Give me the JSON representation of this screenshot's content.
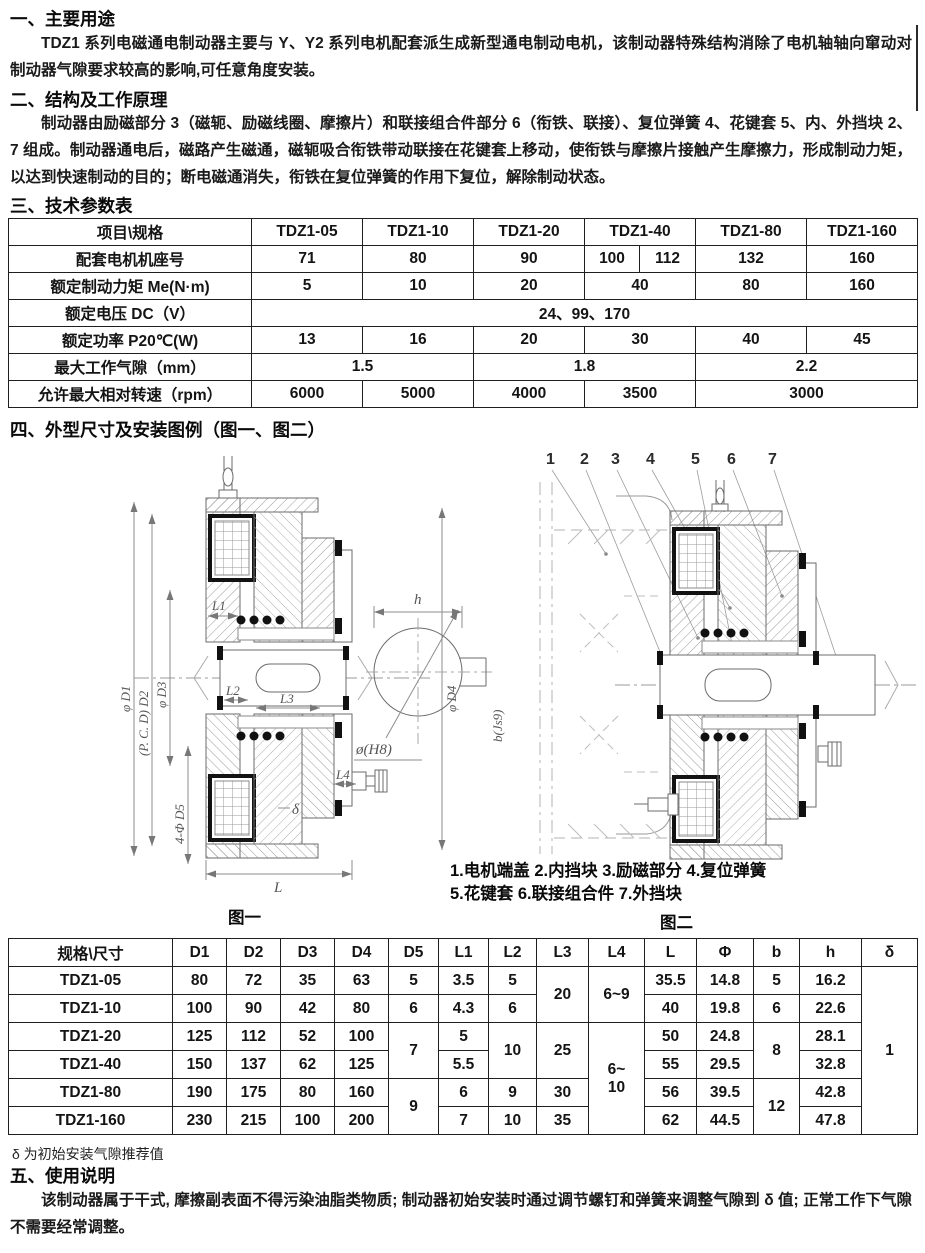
{
  "doc": {
    "s1_heading": "一、主要用途",
    "s1_body": "TDZ1 系列电磁通电制动器主要与 Y、Y2 系列电机配套派生成新型通电制动电机，该制动器特殊结构消除了电机轴轴向窜动对制动器气隙要求较高的影响,可任意角度安装。",
    "s2_heading": "二、结构及工作原理",
    "s2_body": "制动器由励磁部分 3（磁轭、励磁线圈、摩擦片）和联接组合件部分 6（衔铁、联接）、复位弹簧 4、花键套 5、内、外挡块 2、7 组成。制动器通电后，磁路产生磁通，磁轭吸合衔铁带动联接在花键套上移动，使衔铁与摩擦片接触产生摩擦力，形成制动力矩，以达到快速制动的目的；断电磁通消失，衔铁在复位弹簧的作用下复位，解除制动状态。",
    "s3_heading": "三、技术参数表",
    "s4_heading": "四、外型尺寸及安装图例（图一、图二）",
    "s5_heading": "五、使用说明",
    "s5_body": "该制动器属于干式, 摩擦副表面不得污染油脂类物质; 制动器初始安装时通过调节螺钉和弹簧来调整气隙到 δ 值; 正常工作下气隙不需要经常调整。",
    "dims_footnote": "δ 为初始安装气隙推荐值"
  },
  "params_table": {
    "header": [
      "项目\\规格",
      "TDZ1-05",
      "TDZ1-10",
      "TDZ1-20",
      "TDZ1-40",
      "TDZ1-80",
      "TDZ1-160"
    ],
    "frame_row": {
      "label": "配套电机机座号",
      "v": [
        "71",
        "80",
        "90",
        "100",
        "112",
        "132",
        "160"
      ]
    },
    "torque_row": {
      "label": "额定制动力矩 Me(N·m)",
      "v": [
        "5",
        "10",
        "20",
        "40",
        "80",
        "160"
      ]
    },
    "voltage_row": {
      "label": "额定电压 DC（V）",
      "v": "24、99、170"
    },
    "power_row": {
      "label": "额定功率 P20℃(W)",
      "v": [
        "13",
        "16",
        "20",
        "30",
        "40",
        "45"
      ]
    },
    "gap_row": {
      "label": "最大工作气隙（mm）",
      "v": [
        "1.5",
        "1.8",
        "2.2"
      ]
    },
    "speed_row": {
      "label": "允许最大相对转速（rpm）",
      "v": [
        "6000",
        "5000",
        "4000",
        "3500",
        "3000"
      ]
    }
  },
  "dims_table": {
    "header": [
      "规格\\尺寸",
      "D1",
      "D2",
      "D3",
      "D4",
      "D5",
      "L1",
      "L2",
      "L3",
      "L4",
      "L",
      "Φ",
      "b",
      "h",
      "δ"
    ],
    "r05": {
      "spec": "TDZ1-05",
      "D1": "80",
      "D2": "72",
      "D3": "35",
      "D4": "63",
      "D5": "5",
      "L1": "3.5",
      "L2": "5",
      "L3": "20",
      "L4": "6~9",
      "L": "35.5",
      "Phi": "14.8",
      "b": "5",
      "h": "16.2",
      "delta": "1"
    },
    "r10": {
      "spec": "TDZ1-10",
      "D1": "100",
      "D2": "90",
      "D3": "42",
      "D4": "80",
      "D5": "6",
      "L1": "4.3",
      "L2": "6",
      "L": "40",
      "Phi": "19.8",
      "b": "6",
      "h": "22.6"
    },
    "r20": {
      "spec": "TDZ1-20",
      "D1": "125",
      "D2": "112",
      "D3": "52",
      "D4": "100",
      "D5": "7",
      "L1": "5",
      "L2": "10",
      "L3": "25",
      "L4a": "6~",
      "L4b": "10",
      "L": "50",
      "Phi": "24.8",
      "b": "8",
      "h": "28.1"
    },
    "r40": {
      "spec": "TDZ1-40",
      "D1": "150",
      "D2": "137",
      "D3": "62",
      "D4": "125",
      "L1": "5.5",
      "L": "55",
      "Phi": "29.5",
      "h": "32.8"
    },
    "r80": {
      "spec": "TDZ1-80",
      "D1": "190",
      "D2": "175",
      "D3": "80",
      "D4": "160",
      "D5": "9",
      "L1": "6",
      "L2": "9",
      "L3": "30",
      "L": "56",
      "Phi": "39.5",
      "b": "12",
      "h": "42.8"
    },
    "r160": {
      "spec": "TDZ1-160",
      "D1": "230",
      "D2": "215",
      "D3": "100",
      "D4": "200",
      "L1": "7",
      "L2": "10",
      "L3": "35",
      "L": "62",
      "Phi": "44.5",
      "h": "47.8"
    }
  },
  "figure1": {
    "label": "图一",
    "dims": {
      "d1": "φ D1",
      "d2": "(P. C. D) D2",
      "d3": "φ D3",
      "d4": "φ D4",
      "d5": "4-Φ D5",
      "l1": "L1",
      "l2": "L2",
      "l3": "L3",
      "l4": "L4",
      "l": "L",
      "delta": "δ",
      "h": "h",
      "bore": "ø(H8)",
      "key": "b(Js9)"
    }
  },
  "figure2": {
    "label": "图二",
    "callouts": [
      "1",
      "2",
      "3",
      "4",
      "5",
      "6",
      "7"
    ],
    "caption1": "1.电机端盖  2.内挡块  3.励磁部分  4.复位弹簧",
    "caption2": "5.花键套  6.联接组合件  7.外挡块"
  }
}
